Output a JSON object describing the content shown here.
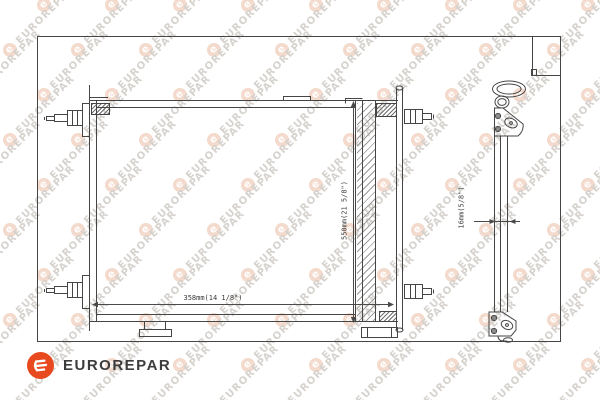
{
  "watermark": {
    "text": "EUROREPAR",
    "letter": "e",
    "text_color": "#D6D2CE",
    "circle_color": "#F3DACC"
  },
  "logo": {
    "text": "EUROREPAR",
    "letter": "e",
    "circle_color": "#E8491E",
    "text_color": "#3C3C3C"
  },
  "drawing": {
    "line_color": "#454545",
    "dimension_labels": {
      "width": "358mm(14 1/8\")",
      "height": "550mm(21 5/8\")",
      "pipe_diameter": "16mm(5/8\")"
    }
  }
}
